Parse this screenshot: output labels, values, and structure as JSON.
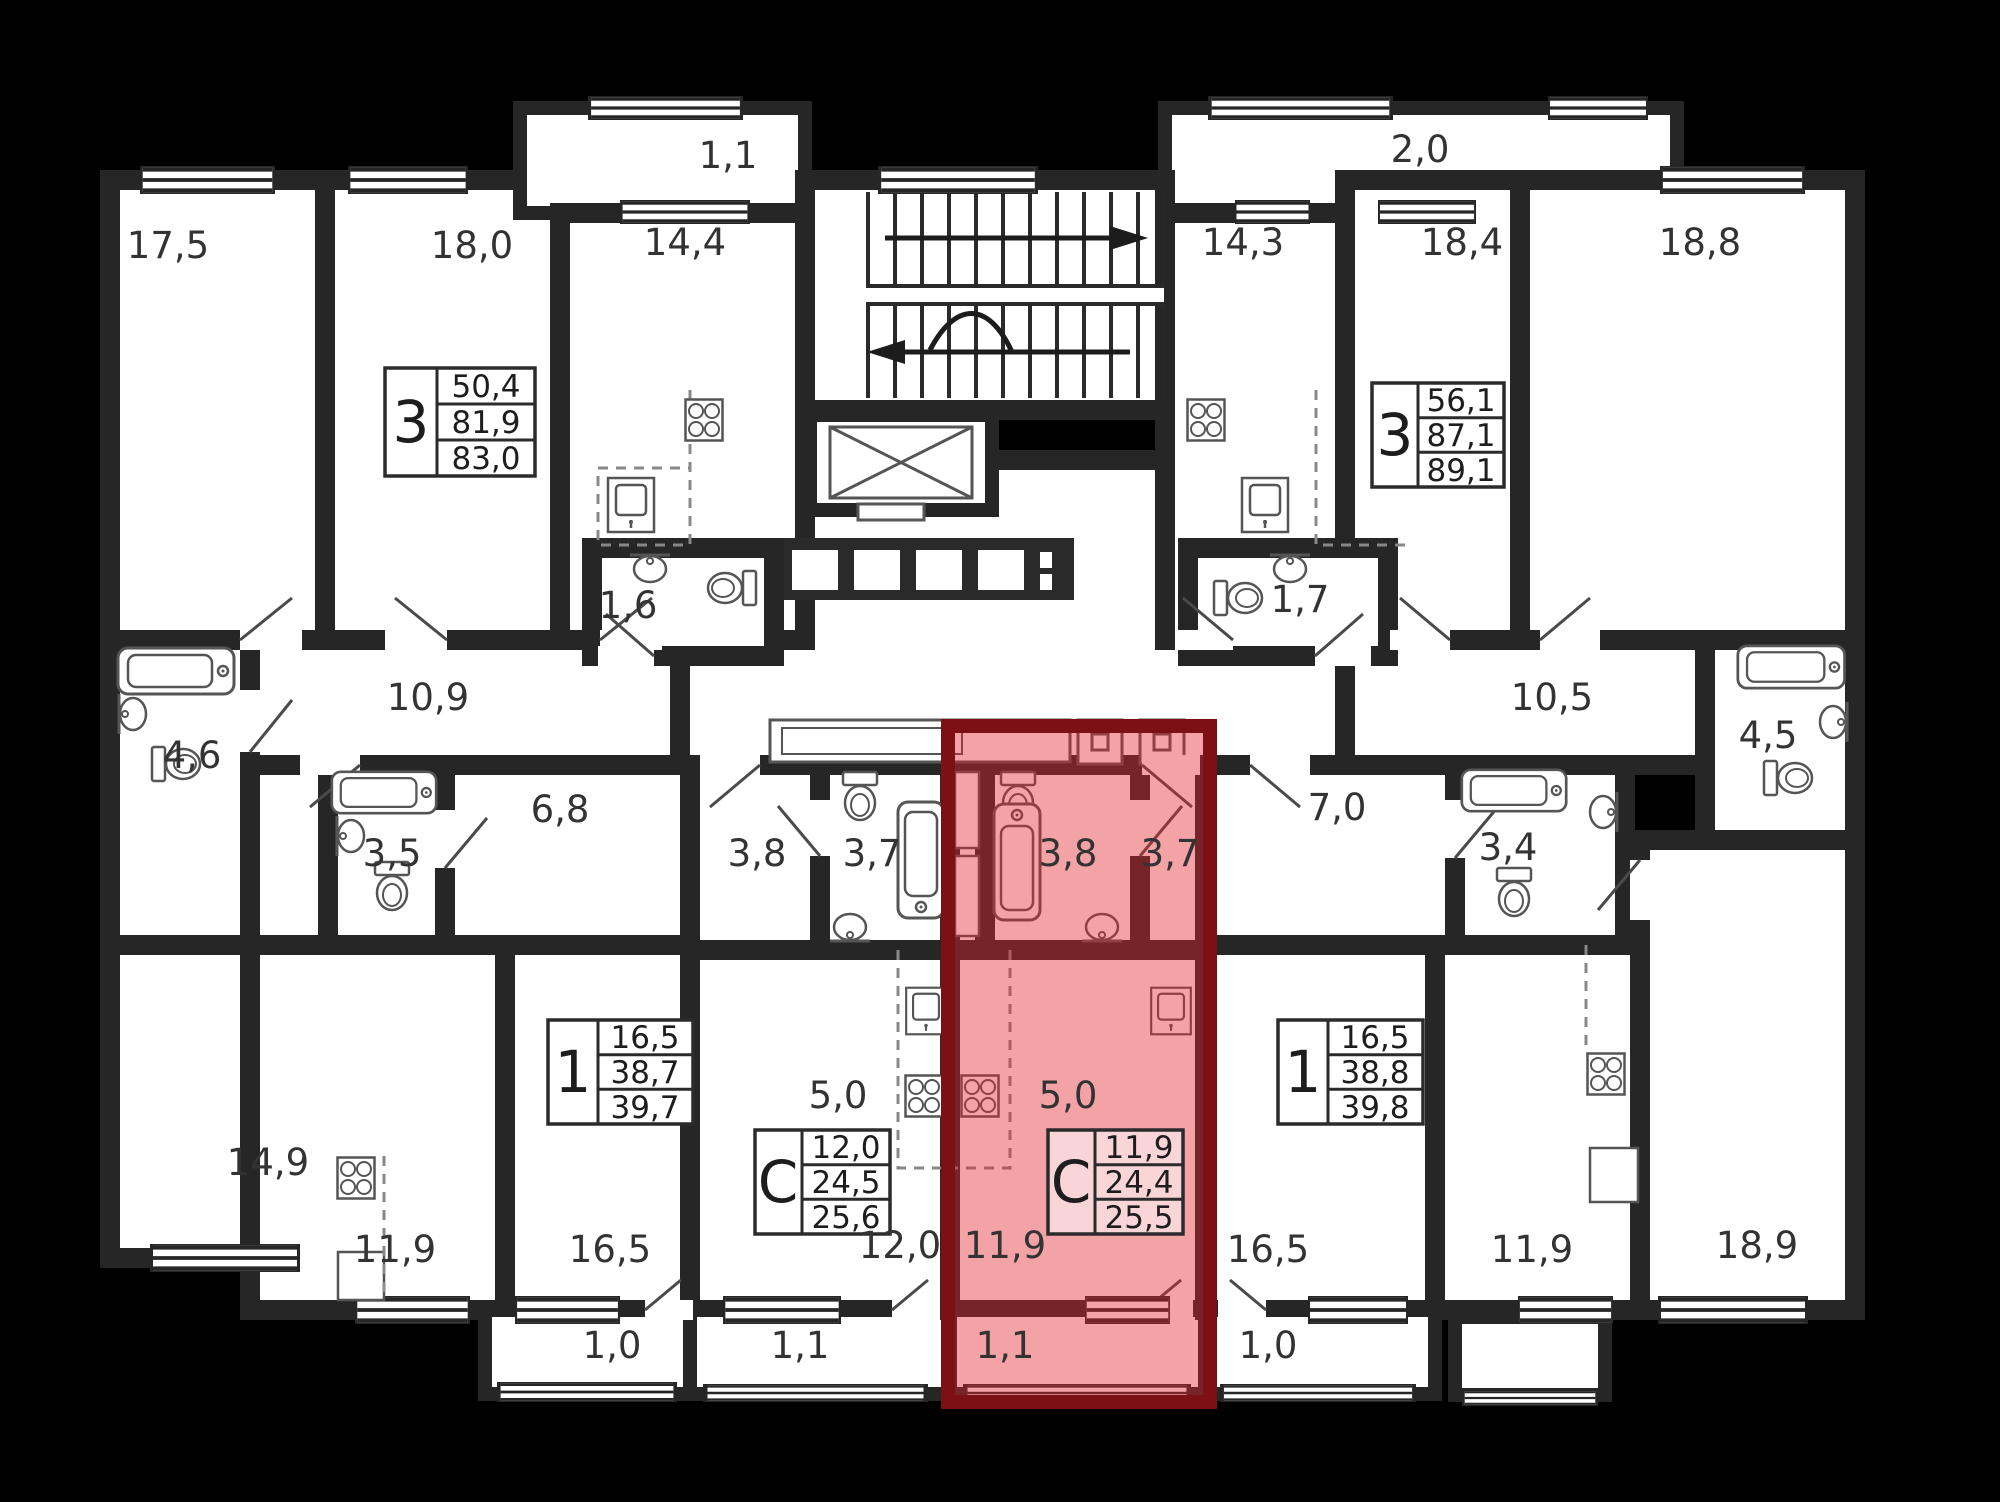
{
  "plan": {
    "type": "residential-floor-plan",
    "highlight_color": "#e2242c",
    "wall_color": "#262626"
  },
  "labels": {
    "r17_5": "17,5",
    "r18_0": "18,0",
    "balc11top": "1,1",
    "k14_4": "14,4",
    "k14_3": "14,3",
    "balc20": "2,0",
    "r18_4": "18,4",
    "r18_8": "18,8",
    "ba4_6": "4,6",
    "corr10_9": "10,9",
    "wc1_6": "1,6",
    "wc1_7": "1,7",
    "corr10_5": "10,5",
    "ba4_5": "4,5",
    "ba3_5": "3,5",
    "hall6_8": "6,8",
    "hall3_8": "3,8",
    "ba3_7": "3,7",
    "ba3_8red": "3,8",
    "hall3_7red": "3,7",
    "hall7_0": "7,0",
    "ba3_4": "3,4",
    "r14_9": "14,9",
    "k11_9left": "11,9",
    "r16_5left": "16,5",
    "k5_0left": "5,0",
    "r12_0": "12,0",
    "k5_0red": "5,0",
    "r11_9red": "11,9",
    "r16_5right": "16,5",
    "k11_9right": "11,9",
    "r18_9": "18,9",
    "balc1_0left": "1,0",
    "balc1_1mid": "1,1",
    "balc1_1red": "1,1",
    "balc1_0right": "1,0"
  },
  "info_boxes": {
    "apt3_left": {
      "type": "3",
      "line1": "50,4",
      "line2": "81,9",
      "line3": "83,0"
    },
    "apt3_right": {
      "type": "3",
      "line1": "56,1",
      "line2": "87,1",
      "line3": "89,1"
    },
    "apt1_left": {
      "type": "1",
      "line1": "16,5",
      "line2": "38,7",
      "line3": "39,7"
    },
    "apt1_right": {
      "type": "1",
      "line1": "16,5",
      "line2": "38,8",
      "line3": "39,8"
    },
    "studio_left": {
      "type": "С",
      "line1": "12,0",
      "line2": "24,5",
      "line3": "25,6"
    },
    "studio_red": {
      "type": "С",
      "line1": "11,9",
      "line2": "24,4",
      "line3": "25,5"
    }
  }
}
